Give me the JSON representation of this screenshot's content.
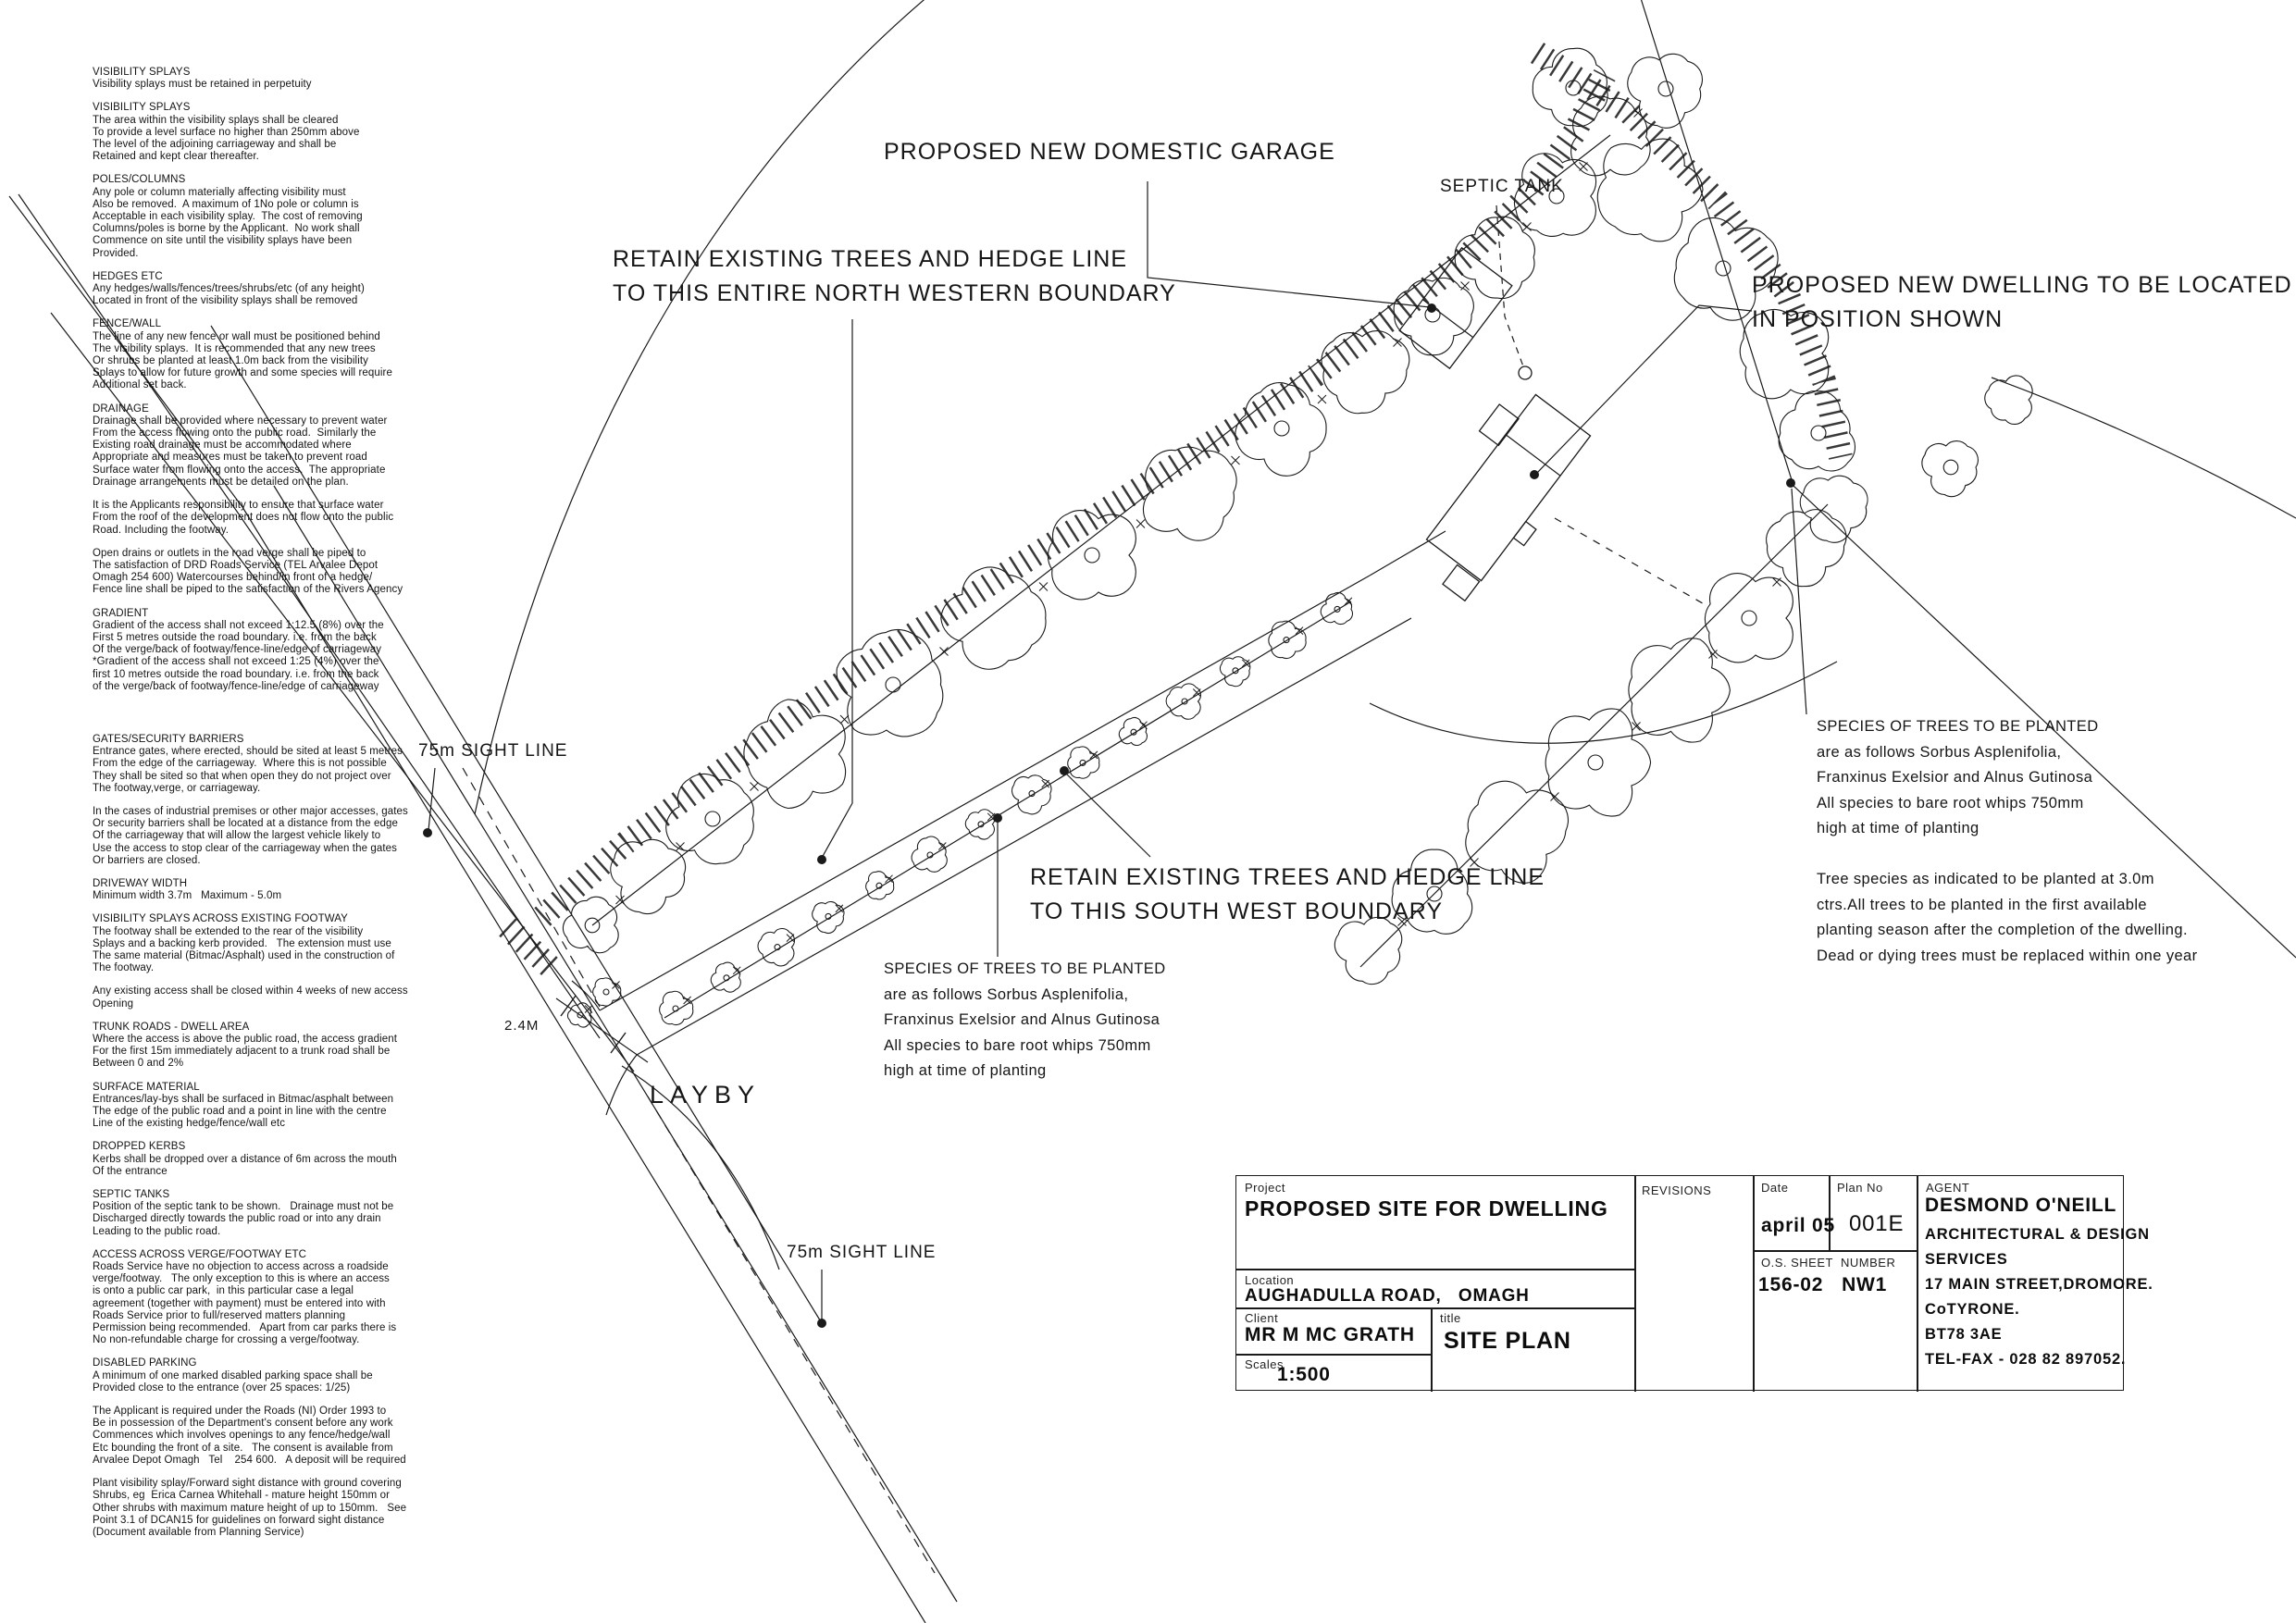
{
  "page": {
    "background": "#ffffff",
    "line_color": "#1a1a1a"
  },
  "notes": {
    "sections": [
      {
        "h": "VISIBILITY SPLAYS",
        "lines": [
          "Visibility splays must be retained in perpetuity"
        ]
      },
      {
        "h": "VISIBILITY SPLAYS",
        "lines": [
          "The area within the visibility splays shall be cleared",
          "To provide a level surface no higher than 250mm above",
          "The level of the adjoining carriageway and shall be",
          "Retained and kept clear thereafter."
        ]
      },
      {
        "h": "POLES/COLUMNS",
        "lines": [
          "Any pole or column materially affecting visibility must",
          "Also be removed.  A maximum of 1No pole or column is",
          "Acceptable in each visibility splay.  The cost of removing",
          "Columns/poles is borne by the Applicant.  No work shall",
          "Commence on site until the visibility splays have been",
          "Provided."
        ]
      },
      {
        "h": "HEDGES ETC",
        "lines": [
          "Any hedges/walls/fences/trees/shrubs/etc (of any height)",
          "Located in front of the visibility splays shall be removed"
        ]
      },
      {
        "h": "FENCE/WALL",
        "lines": [
          "The line of any new fence or wall must be positioned behind",
          "The visibility splays.  It is recommended that any new trees",
          "Or shrubs be planted at least 1.0m back from the visibility",
          "Splays to allow for future growth and some species will require",
          "Additional set back."
        ]
      },
      {
        "h": "DRAINAGE",
        "lines": [
          "Drainage shall be provided where necessary to prevent water",
          "From the access flowing onto the public road.  Similarly the",
          "Existing road drainage must be accommodated where",
          "Appropriate and measures must be taken to prevent road",
          "Surface water from flowing onto the access.  The appropriate",
          "Drainage arrangements must be detailed on the plan."
        ]
      },
      {
        "h": "",
        "lines": [
          "It is the Applicants responsibility to ensure that surface water",
          "From the roof of the development does not flow onto the public",
          "Road. Including the footway."
        ]
      },
      {
        "h": "",
        "lines": [
          "Open drains or outlets in the road verge shall be piped to",
          "The satisfaction of DRD Roads Service (TEL Arvalee Depot",
          "Omagh 254 600) Watercourses behind/in front of a hedge/",
          "Fence line shall be piped to the satisfaction of the Rivers Agency"
        ]
      },
      {
        "h": "GRADIENT",
        "gap": true,
        "lines": [
          "Gradient of the access shall not exceed 1:12.5 (8%) over the",
          "First 5 metres outside the road boundary. i.e. from the back",
          "Of the verge/back of footway/fence-line/edge of carriageway",
          "*Gradient of the access shall not exceed 1:25 (4%) over the",
          "first 10 metres outside the road boundary. i.e. from the back",
          "of the verge/back of footway/fence-line/edge of carriageway"
        ]
      },
      {
        "h": "GATES/SECURITY BARRIERS",
        "lines": [
          "Entrance gates, where erected, should be sited at least 5 metres",
          "From the edge of the carriageway.  Where this is not possible",
          "They shall be sited so that when open they do not project over",
          "The footway,verge, or carriageway."
        ]
      },
      {
        "h": "",
        "lines": [
          "In the cases of industrial premises or other major accesses, gates",
          "Or security barriers shall be located at a distance from the edge",
          "Of the carriageway that will allow the largest vehicle likely to",
          "Use the access to stop clear of the carriageway when the gates",
          "Or barriers are closed."
        ]
      },
      {
        "h": "DRIVEWAY WIDTH",
        "lines": [
          "Minimum width 3.7m   Maximum - 5.0m"
        ]
      },
      {
        "h": "VISIBILITY SPLAYS ACROSS EXISTING FOOTWAY",
        "lines": [
          "The footway shall be extended to the rear of the visibility",
          "Splays and a backing kerb provided.   The extension must use",
          "The same material (Bitmac/Asphalt) used in the construction of",
          "The footway."
        ]
      },
      {
        "h": "",
        "lines": [
          "Any existing access shall be closed within 4 weeks of new access",
          "Opening"
        ]
      },
      {
        "h": "TRUNK ROADS - DWELL AREA",
        "lines": [
          "Where the access is above the public road, the access gradient",
          "For the first 15m immediately adjacent to a trunk road shall be",
          "Between 0 and 2%"
        ]
      },
      {
        "h": "SURFACE MATERIAL",
        "lines": [
          "Entrances/lay-bys shall be surfaced in Bitmac/asphalt between",
          "The edge of the public road and a point in line with the centre",
          "Line of the existing hedge/fence/wall etc"
        ]
      },
      {
        "h": "DROPPED KERBS",
        "lines": [
          "Kerbs shall be dropped over a distance of 6m across the mouth",
          "Of the entrance"
        ]
      },
      {
        "h": "SEPTIC TANKS",
        "lines": [
          "Position of the septic tank to be shown.   Drainage must not be",
          "Discharged directly towards the public road or into any drain",
          "Leading to the public road."
        ]
      },
      {
        "h": "ACCESS ACROSS VERGE/FOOTWAY ETC",
        "lines": [
          "Roads Service have no objection to access across a roadside",
          "verge/footway.   The only exception to this is where an access",
          "is onto a public car park,  in this particular case a legal",
          "agreement (together with payment) must be entered into with",
          "Roads Service prior to full/reserved matters planning",
          "Permission being recommended.   Apart from car parks there is",
          "No non-refundable charge for crossing a verge/footway."
        ]
      },
      {
        "h": "DISABLED PARKING",
        "lines": [
          "A minimum of one marked disabled parking space shall be",
          "Provided close to the entrance (over 25 spaces: 1/25)"
        ]
      },
      {
        "h": "",
        "lines": [
          "The Applicant is required under the Roads (NI) Order 1993 to",
          "Be in possession of the Department's consent before any work",
          "Commences which involves openings to any fence/hedge/wall",
          "Etc bounding the front of a site.   The consent is available from",
          "Arvalee Depot Omagh   Tel    254 600.   A deposit will be required"
        ]
      },
      {
        "h": "",
        "lines": [
          "Plant visibility splay/Forward sight distance with ground covering",
          "Shrubs, eg  Erica Carnea Whitehall - mature height 150mm or",
          "Other shrubs with maximum mature height of up to 150mm.   See",
          "Point 3.1 of DCAN15 for guidelines on forward sight distance",
          "(Document available from Planning Service)"
        ]
      }
    ]
  },
  "plan_labels": {
    "garage": "PROPOSED NEW DOMESTIC GARAGE",
    "septic_tank": "SEPTIC TANK",
    "retain_nw": "RETAIN EXISTING TREES AND HEDGE LINE\nTO THIS ENTIRE NORTH WESTERN BOUNDARY",
    "dwelling": "PROPOSED NEW DWELLING TO BE LOCATED\nIN POSITION SHOWN",
    "retain_sw": "RETAIN EXISTING TREES AND HEDGE LINE\nTO THIS SOUTH WEST BOUNDARY",
    "species_mid": "SPECIES OF TREES TO BE PLANTED\nare as follows Sorbus Asplenifolia,\nFranxinus Exelsior and Alnus Gutinosa\nAll species to bare root whips 750mm\nhigh at time of planting",
    "species_right": "SPECIES OF TREES TO BE PLANTED\nare as follows Sorbus Asplenifolia,\nFranxinus Exelsior and Alnus Gutinosa\nAll species to bare root whips 750mm\nhigh at time of planting\n\nTree species as indicated to be planted at 3.0m\nctrs.All trees to be planted in the first available\nplanting season after the completion of the dwelling.\nDead or dying trees must be replaced within one year",
    "sight_line": "75m SIGHT LINE",
    "layby": "LAYBY",
    "entrance_width": "2.4M"
  },
  "title_block": {
    "project_label": "Project",
    "project": "PROPOSED SITE FOR DWELLING",
    "revisions_label": "REVISIONS",
    "location_label": "Location",
    "location": "AUGHADULLA ROAD,   OMAGH",
    "client_label": "Client",
    "client": "MR M MC GRATH",
    "scales_label": "Scales",
    "scales": "1:500",
    "title_label": "title",
    "title": "SITE PLAN",
    "date_label": "Date",
    "date": "april 05",
    "plan_no_label": "Plan No",
    "plan_no": "001E",
    "os_sheet_label": "O.S. SHEET",
    "os_number_label": "NUMBER",
    "os_sheet": "156-02   NW1",
    "agent_label": "AGENT",
    "agent_name": "DESMOND O'NEILL",
    "agent_lines": "ARCHITECTURAL & DESIGN\nSERVICES\n17 MAIN STREET,DROMORE.\nCoTYRONE.\nBT78 3AE\nTEL-FAX - 028 82 897052."
  }
}
